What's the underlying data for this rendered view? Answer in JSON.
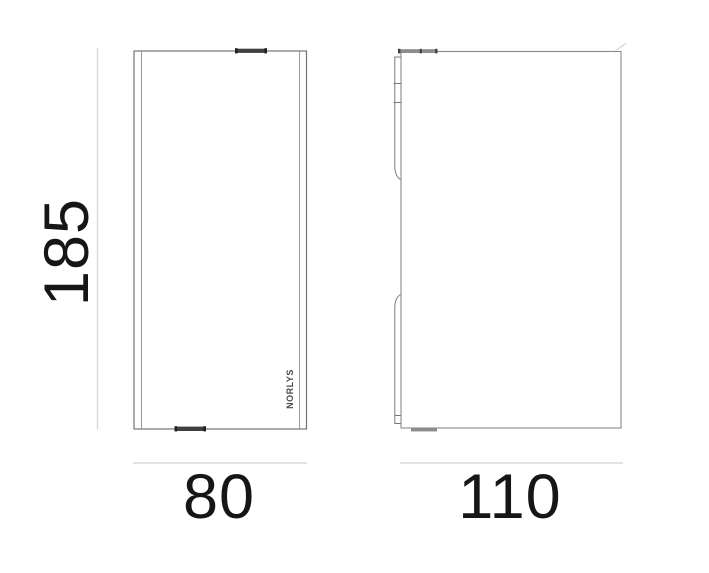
{
  "dimensions": {
    "height": {
      "value": "185"
    },
    "front_width": {
      "value": "80"
    },
    "side_depth": {
      "value": "110"
    }
  },
  "front_view": {
    "logo_text": "NORLYS"
  },
  "colors": {
    "outline": "#757575",
    "inner_edge": "#9a9a9a",
    "bracket_line": "#7a7a7a",
    "clip_dark": "#3f3f3f",
    "clip_cap": "#1f1f1f",
    "clip_gray": "#8c8c8c",
    "dimension_line": "#dadada",
    "corner_tick": "#c9c9c9",
    "label_text": "#161616",
    "logo_text": "#4a4a4a"
  }
}
